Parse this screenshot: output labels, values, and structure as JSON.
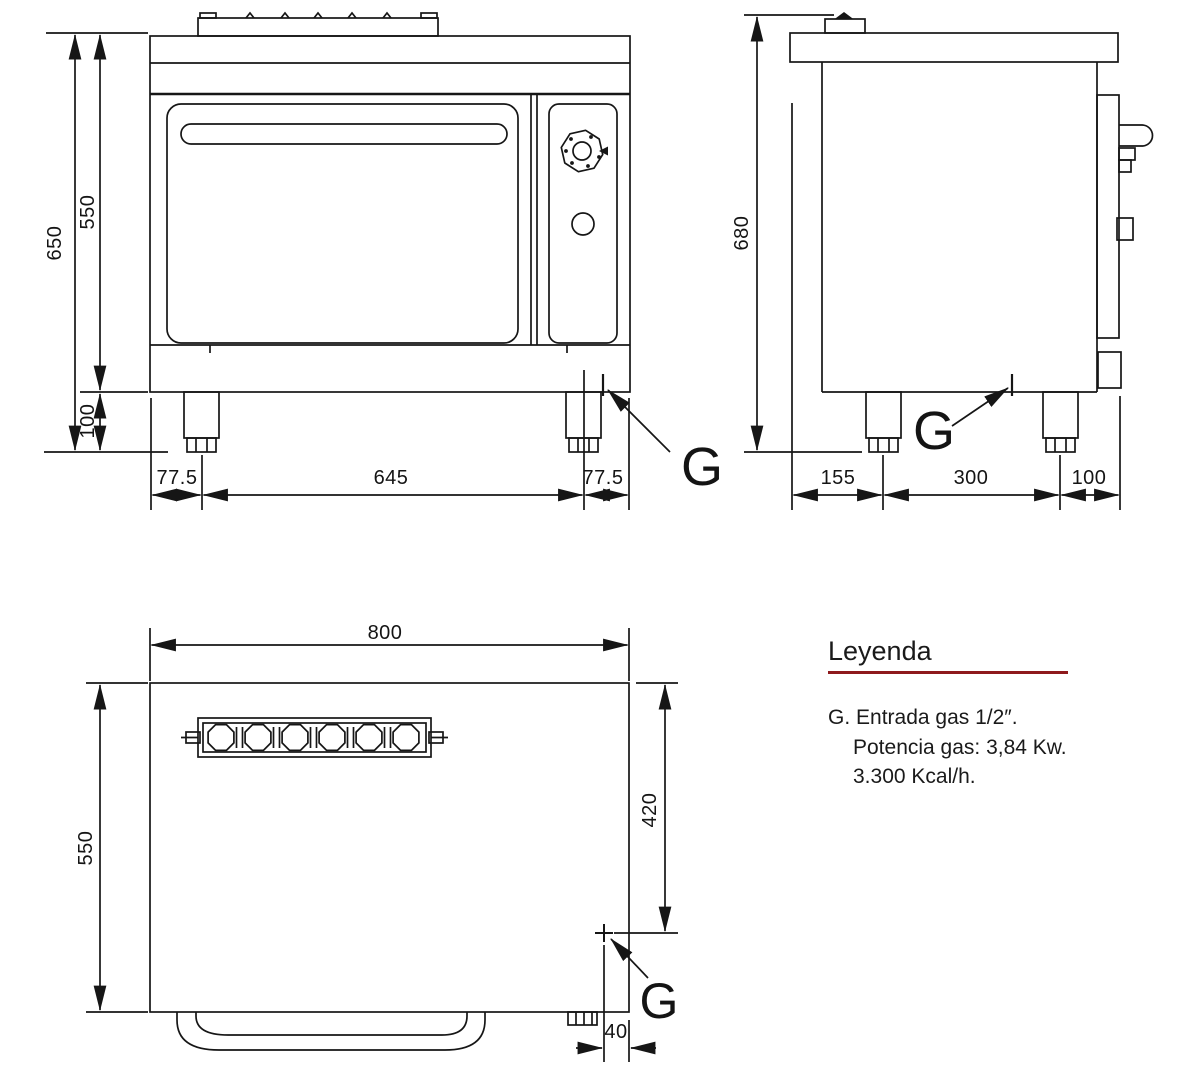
{
  "front_view": {
    "dim_total_height": "650",
    "dim_body_height": "550",
    "dim_leg_height": "100",
    "dim_left_offset": "77.5",
    "dim_burner_span": "645",
    "dim_right_offset": "77.5",
    "gas_point_label": "G"
  },
  "side_view": {
    "dim_total_height": "680",
    "dim_back_offset": "155",
    "dim_leg_span": "300",
    "dim_front_offset": "100",
    "gas_point_label": "G"
  },
  "plan_view": {
    "dim_width": "800",
    "dim_depth": "550",
    "dim_gas_from_top": "420",
    "dim_gas_from_right": "40",
    "gas_point_label": "G"
  },
  "legend": {
    "title": "Leyenda",
    "line1": "G. Entrada gas 1/2″.",
    "line2": "Potencia gas: 3,84 Kw.",
    "line3": "3.300 Kcal/h.",
    "accent_color": "#8e191c"
  },
  "colors": {
    "line": "#161616",
    "background": "#ffffff"
  }
}
